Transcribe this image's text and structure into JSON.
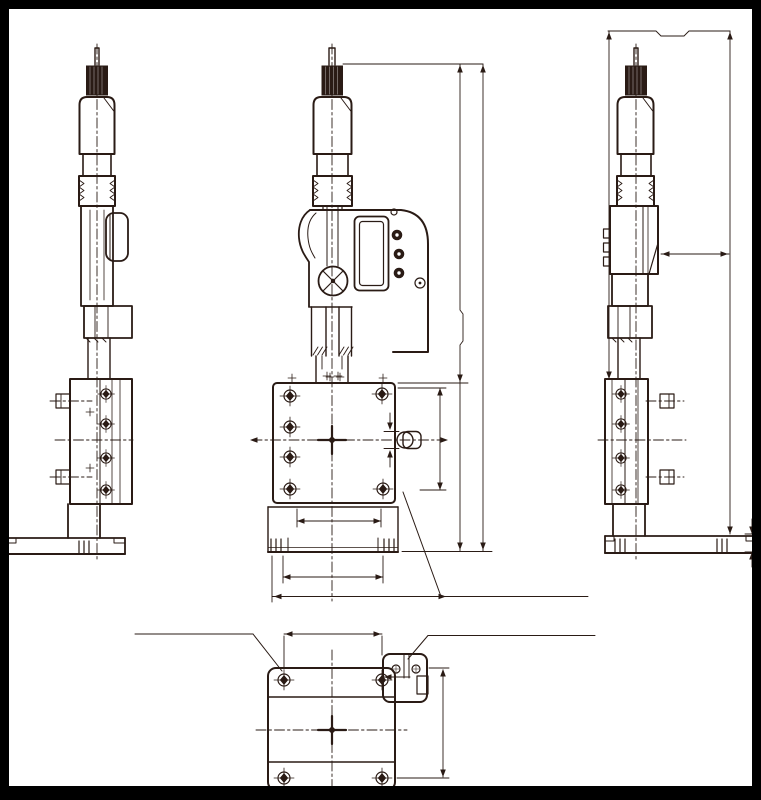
{
  "document": {
    "kind": "engineering-dimension-drawing",
    "subject": "micrometer-head-positioning-stage",
    "visible_text": []
  },
  "colors": {
    "line": "#2a1b15",
    "background": "#ffffff",
    "frame": "#000000"
  },
  "views": [
    {
      "id": "left",
      "name": "left-side-view"
    },
    {
      "id": "front",
      "name": "front-view-with-digital-display"
    },
    {
      "id": "right",
      "name": "right-side-view-with-height-dimensions"
    },
    {
      "id": "plan",
      "name": "bottom-plan-view-of-stage"
    }
  ],
  "features": {
    "display": "lcd-panel-with-three-buttons",
    "stage_holes": "counterbored-mounting-holes",
    "clamp": "side-clamp-screws",
    "dimensions": "unlabelled-dimension-lines-with-arrowheads"
  }
}
